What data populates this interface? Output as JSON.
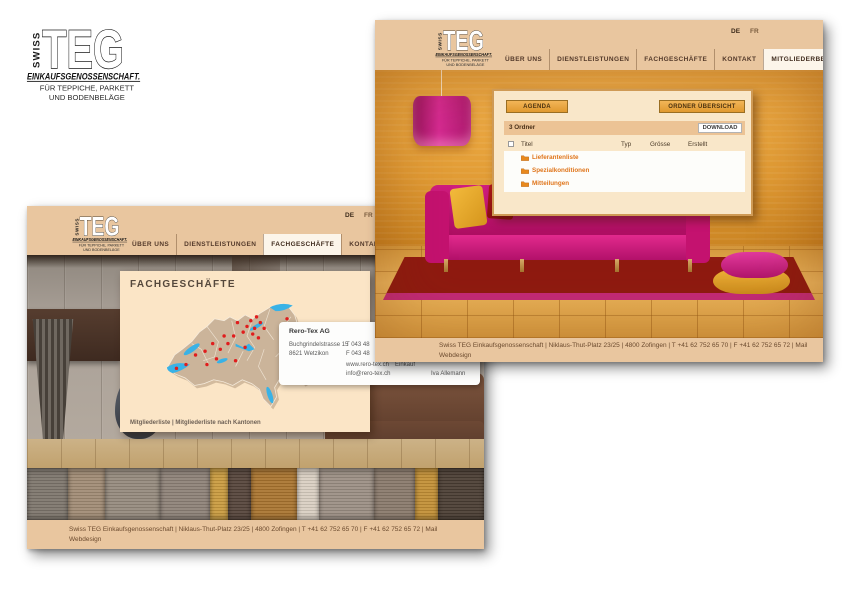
{
  "brand": {
    "vertical": "SWISS",
    "main": "TEG",
    "line1": "EINKAUFSGENOSSENSCHAFT.",
    "line2": "FÜR TEPPICHE, PARKETT",
    "line3": "UND BODENBELÄGE"
  },
  "nav": {
    "items": [
      {
        "label": "ÜBER UNS"
      },
      {
        "label": "DIENSTLEISTUNGEN"
      },
      {
        "label": "FACHGESCHÄFTE"
      },
      {
        "label": "KONTAKT"
      },
      {
        "label": "MITGLIEDERBEREICH"
      }
    ],
    "lang_de": "DE",
    "lang_fr": "FR"
  },
  "footer": {
    "line1": "Swiss TEG Einkaufsgenossenschaft | Niklaus-Thut-Platz 23/25 | 4800 Zofingen | T +41 62 752 65 70 | F +41 62 752 65 72 | Mail",
    "line2": "Webdesign"
  },
  "members_page": {
    "active_nav": "MITGLIEDERBEREICH",
    "agenda_button": "AGENDA",
    "ordner_button": "ORDNER ÜBERSICHT",
    "folder_count": "3 Ordner",
    "download_button": "DOWNLOAD",
    "table": {
      "columns": [
        "Titel",
        "Typ",
        "Grösse",
        "Erstellt"
      ],
      "rows": [
        {
          "title": "Lieferantenliste"
        },
        {
          "title": "Spezialkonditionen"
        },
        {
          "title": "Mitteilungen"
        }
      ]
    }
  },
  "shops_page": {
    "active_nav": "FACHGESCHÄFTE",
    "title": "FACHGESCHÄFTE",
    "links": {
      "a": "Mitgliederliste",
      "sep": " | ",
      "b": "Mitgliederliste nach Kantonen"
    },
    "tooltip": {
      "title": "Rero-Tex AG",
      "address1": "Buchgrindelstrasse 15",
      "address2": "8621 Wetzikon",
      "phone": "T 043 48",
      "fax": "F 043 48",
      "web": "www.rero-tex.ch",
      "email": "info@rero-tex.ch",
      "role": "Einkauf",
      "person": "Iva Allemann"
    },
    "carpet_colors": [
      "#7d756c",
      "#a08b74",
      "#958a7d",
      "#8d8177",
      "#c99b3f",
      "#55443a",
      "#a9742f",
      "#d9cfc2",
      "#9b8e83",
      "#89796b",
      "#c28f35",
      "#4a3d33"
    ]
  },
  "colors": {
    "header_beige": "#e9c69f",
    "panel_beige": "#f9e7c9",
    "button_orange": "#e8a53c",
    "folder_orange": "#e0761c",
    "sofa_magenta": "#c4126f",
    "rug_red": "#8f1a10",
    "lake_blue": "#39b2e6",
    "dot_red": "#e01d1d"
  }
}
